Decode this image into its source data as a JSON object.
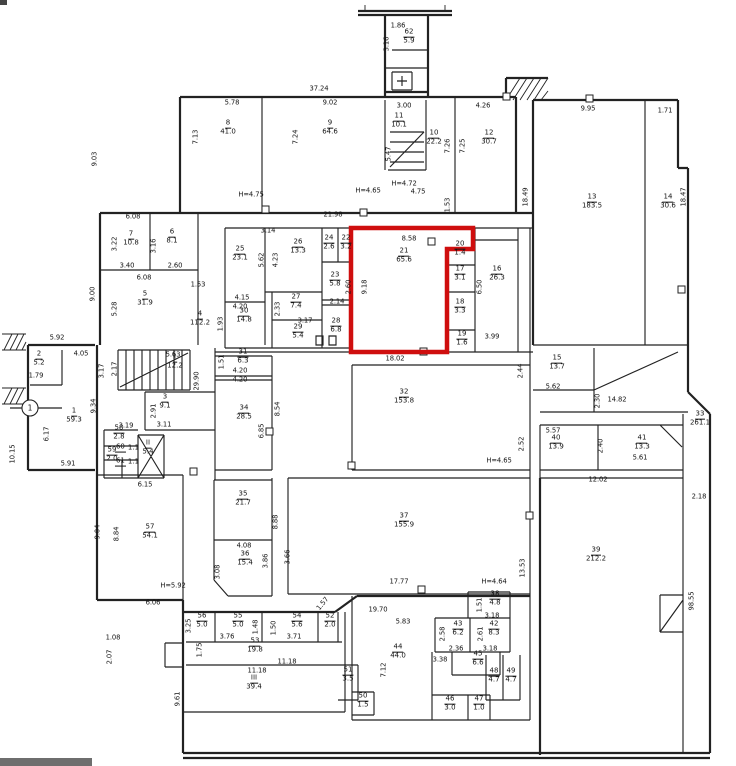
{
  "colors": {
    "wall": "#222222",
    "highlight": "#cf0e0e",
    "ink": "#141414",
    "paper": "#ffffff"
  },
  "highlight": {
    "room_no": "21",
    "area": "65.6",
    "width_dim": "8.58",
    "height_dim": "9.18",
    "bottom_dim": "18.02"
  },
  "rooms": [
    {
      "no": "62",
      "area": "5.9",
      "x": 409,
      "y": 37
    },
    {
      "no": "8",
      "area": "41.0",
      "x": 228,
      "y": 128
    },
    {
      "no": "9",
      "area": "64.6",
      "x": 330,
      "y": 128
    },
    {
      "no": "11",
      "area": "10.1",
      "x": 399,
      "y": 121
    },
    {
      "no": "10",
      "area": "22.2",
      "x": 434,
      "y": 138
    },
    {
      "no": "12",
      "area": "30.7",
      "x": 489,
      "y": 138
    },
    {
      "no": "13",
      "area": "183.5",
      "x": 592,
      "y": 202
    },
    {
      "no": "14",
      "area": "30.6",
      "x": 668,
      "y": 202
    },
    {
      "no": "7",
      "area": "10.8",
      "x": 131,
      "y": 239
    },
    {
      "no": "6",
      "area": "8.1",
      "x": 172,
      "y": 237
    },
    {
      "no": "5",
      "area": "31.9",
      "x": 145,
      "y": 299
    },
    {
      "no": "4",
      "area": "112.2",
      "x": 200,
      "y": 319
    },
    {
      "no": "25",
      "area": "23.1",
      "x": 240,
      "y": 254
    },
    {
      "no": "26",
      "area": "13.3",
      "x": 298,
      "y": 247
    },
    {
      "no": "24",
      "area": "2.6",
      "x": 329,
      "y": 243
    },
    {
      "no": "22",
      "area": "3.2",
      "x": 346,
      "y": 243
    },
    {
      "no": "23",
      "area": "5.8",
      "x": 335,
      "y": 280
    },
    {
      "no": "30",
      "area": "14.8",
      "x": 244,
      "y": 316
    },
    {
      "no": "27",
      "area": "7.4",
      "x": 296,
      "y": 302
    },
    {
      "no": "29",
      "area": "5.4",
      "x": 298,
      "y": 332
    },
    {
      "no": "28",
      "area": "6.8",
      "x": 336,
      "y": 326
    },
    {
      "no": "21",
      "area": "65.6",
      "x": 404,
      "y": 256
    },
    {
      "no": "20",
      "area": "1.4",
      "x": 460,
      "y": 249
    },
    {
      "no": "17",
      "area": "3.1",
      "x": 460,
      "y": 274
    },
    {
      "no": "18",
      "area": "3.3",
      "x": 460,
      "y": 307
    },
    {
      "no": "19",
      "area": "1.6",
      "x": 462,
      "y": 339
    },
    {
      "no": "16",
      "area": "26.3",
      "x": 497,
      "y": 274
    },
    {
      "no": "15",
      "area": "13.7",
      "x": 557,
      "y": 363
    },
    {
      "no": "33",
      "area": "261.1",
      "x": 700,
      "y": 419
    },
    {
      "no": "2",
      "area": "5.2",
      "x": 39,
      "y": 359
    },
    {
      "no": "1",
      "area": "59.3",
      "x": 74,
      "y": 416
    },
    {
      "no": "I",
      "area": "12.2",
      "x": 175,
      "y": 362
    },
    {
      "no": "3",
      "area": "9.1",
      "x": 165,
      "y": 402
    },
    {
      "no": "58",
      "area": "2.8",
      "x": 119,
      "y": 433
    },
    {
      "no": "59",
      "area": "2.0",
      "x": 112,
      "y": 455
    },
    {
      "no": "60",
      "area": "1.1",
      "x": 127,
      "y": 448,
      "h": true
    },
    {
      "no": "61",
      "area": "1.1",
      "x": 127,
      "y": 462,
      "h": true
    },
    {
      "no": "II",
      "area": "5.4",
      "x": 148,
      "y": 448
    },
    {
      "no": "57",
      "area": "54.1",
      "x": 150,
      "y": 532
    },
    {
      "no": "31",
      "area": "6.3",
      "x": 243,
      "y": 357
    },
    {
      "no": "34",
      "area": "28.5",
      "x": 244,
      "y": 413
    },
    {
      "no": "32",
      "area": "153.8",
      "x": 404,
      "y": 397
    },
    {
      "no": "40",
      "area": "13.9",
      "x": 556,
      "y": 443
    },
    {
      "no": "41",
      "area": "13.3",
      "x": 642,
      "y": 443
    },
    {
      "no": "39",
      "area": "212.2",
      "x": 596,
      "y": 555
    },
    {
      "no": "35",
      "area": "21.7",
      "x": 243,
      "y": 499
    },
    {
      "no": "36",
      "area": "15.4",
      "x": 245,
      "y": 559
    },
    {
      "no": "37",
      "area": "155.9",
      "x": 404,
      "y": 521
    },
    {
      "no": "56",
      "area": "5.0",
      "x": 202,
      "y": 621
    },
    {
      "no": "55",
      "area": "5.0",
      "x": 238,
      "y": 621
    },
    {
      "no": "54",
      "area": "5.6",
      "x": 297,
      "y": 621
    },
    {
      "no": "52",
      "area": "2.0",
      "x": 330,
      "y": 621
    },
    {
      "no": "53",
      "area": "19.8",
      "x": 255,
      "y": 646
    },
    {
      "no": "III",
      "area": "39.4",
      "x": 254,
      "y": 683
    },
    {
      "no": "51",
      "area": "3.5",
      "x": 348,
      "y": 675
    },
    {
      "no": "50",
      "area": "1.5",
      "x": 363,
      "y": 701
    },
    {
      "no": "38",
      "area": "4.8",
      "x": 495,
      "y": 599
    },
    {
      "no": "43",
      "area": "6.2",
      "x": 458,
      "y": 629
    },
    {
      "no": "42",
      "area": "8.3",
      "x": 494,
      "y": 629
    },
    {
      "no": "44",
      "area": "44.0",
      "x": 398,
      "y": 652
    },
    {
      "no": "45",
      "area": "6.6",
      "x": 478,
      "y": 659
    },
    {
      "no": "48",
      "area": "4.7",
      "x": 494,
      "y": 676
    },
    {
      "no": "49",
      "area": "4.7",
      "x": 511,
      "y": 676
    },
    {
      "no": "46",
      "area": "3.0",
      "x": 450,
      "y": 704
    },
    {
      "no": "47",
      "area": "1.0",
      "x": 479,
      "y": 704
    }
  ],
  "dims": [
    {
      "t": "1.86",
      "x": 398,
      "y": 26
    },
    {
      "t": "3.16",
      "x": 387,
      "y": 44,
      "r": 1
    },
    {
      "t": "37.24",
      "x": 319,
      "y": 89
    },
    {
      "t": "5.78",
      "x": 232,
      "y": 103
    },
    {
      "t": "9.02",
      "x": 330,
      "y": 103
    },
    {
      "t": "3.00",
      "x": 404,
      "y": 106
    },
    {
      "t": "4.26",
      "x": 483,
      "y": 106
    },
    {
      "t": "9.95",
      "x": 588,
      "y": 109
    },
    {
      "t": "1.71",
      "x": 665,
      "y": 111
    },
    {
      "t": "7.13",
      "x": 196,
      "y": 137,
      "r": 1
    },
    {
      "t": "7.24",
      "x": 296,
      "y": 137,
      "r": 1
    },
    {
      "t": "5.47",
      "x": 389,
      "y": 154,
      "r": 1
    },
    {
      "t": "7.26",
      "x": 448,
      "y": 146,
      "r": 1
    },
    {
      "t": "7.25",
      "x": 463,
      "y": 146,
      "r": 1
    },
    {
      "t": "18.49",
      "x": 526,
      "y": 197,
      "r": 1
    },
    {
      "t": "18.47",
      "x": 684,
      "y": 197,
      "r": 1
    },
    {
      "t": "H=4.75",
      "x": 251,
      "y": 195
    },
    {
      "t": "H=4.65",
      "x": 368,
      "y": 191
    },
    {
      "t": "H=4.72",
      "x": 404,
      "y": 184
    },
    {
      "t": "4.75",
      "x": 418,
      "y": 192
    },
    {
      "t": "1.53",
      "x": 448,
      "y": 205,
      "r": 1
    },
    {
      "t": "9.03",
      "x": 95,
      "y": 159,
      "r": 1
    },
    {
      "t": "6.08",
      "x": 133,
      "y": 217
    },
    {
      "t": "21.98",
      "x": 333,
      "y": 215
    },
    {
      "t": "3.22",
      "x": 115,
      "y": 244,
      "r": 1
    },
    {
      "t": "3.40",
      "x": 127,
      "y": 266
    },
    {
      "t": "3.16",
      "x": 154,
      "y": 246,
      "r": 1
    },
    {
      "t": "2.60",
      "x": 175,
      "y": 266
    },
    {
      "t": "6.08",
      "x": 144,
      "y": 278
    },
    {
      "t": "9.00",
      "x": 93,
      "y": 294,
      "r": 1
    },
    {
      "t": "5.28",
      "x": 115,
      "y": 309,
      "r": 1
    },
    {
      "t": "1.53",
      "x": 198,
      "y": 285
    },
    {
      "t": "2.14",
      "x": 337,
      "y": 302
    },
    {
      "t": "2.60",
      "x": 349,
      "y": 287,
      "r": 1
    },
    {
      "t": "3.14",
      "x": 268,
      "y": 231
    },
    {
      "t": "4.23",
      "x": 276,
      "y": 260,
      "r": 1
    },
    {
      "t": "5.62",
      "x": 262,
      "y": 260,
      "r": 1
    },
    {
      "t": "4.15",
      "x": 242,
      "y": 298
    },
    {
      "t": "4.20",
      "x": 240,
      "y": 307
    },
    {
      "t": "1.93",
      "x": 221,
      "y": 324,
      "r": 1
    },
    {
      "t": "2.33",
      "x": 278,
      "y": 309,
      "r": 1
    },
    {
      "t": "3.17",
      "x": 305,
      "y": 321
    },
    {
      "t": "8.58",
      "x": 409,
      "y": 239
    },
    {
      "t": "9.18",
      "x": 365,
      "y": 287,
      "r": 1
    },
    {
      "t": "18.02",
      "x": 395,
      "y": 359
    },
    {
      "t": "6.50",
      "x": 480,
      "y": 287,
      "r": 1
    },
    {
      "t": "3.99",
      "x": 492,
      "y": 337
    },
    {
      "t": "2.44",
      "x": 521,
      "y": 371,
      "r": 1
    },
    {
      "t": "5.62",
      "x": 553,
      "y": 387
    },
    {
      "t": "2.30",
      "x": 598,
      "y": 401,
      "r": 1
    },
    {
      "t": "14.82",
      "x": 617,
      "y": 400
    },
    {
      "t": "5.92",
      "x": 57,
      "y": 338
    },
    {
      "t": "1.79",
      "x": 36,
      "y": 376
    },
    {
      "t": "4.05",
      "x": 81,
      "y": 354
    },
    {
      "t": "3.17",
      "x": 102,
      "y": 371,
      "r": 1
    },
    {
      "t": "2.17",
      "x": 115,
      "y": 369,
      "r": 1
    },
    {
      "t": "9.34",
      "x": 94,
      "y": 406,
      "r": 1
    },
    {
      "t": "6.17",
      "x": 47,
      "y": 434,
      "r": 1
    },
    {
      "t": "10.15",
      "x": 13,
      "y": 454,
      "r": 1
    },
    {
      "t": "5.91",
      "x": 68,
      "y": 464
    },
    {
      "t": "5.63",
      "x": 173,
      "y": 355
    },
    {
      "t": "29.90",
      "x": 197,
      "y": 381,
      "r": 1
    },
    {
      "t": "2.91",
      "x": 154,
      "y": 411,
      "r": 1
    },
    {
      "t": "3.11",
      "x": 164,
      "y": 425
    },
    {
      "t": "3.19",
      "x": 126,
      "y": 426
    },
    {
      "t": "6.15",
      "x": 145,
      "y": 485
    },
    {
      "t": "9.04",
      "x": 98,
      "y": 532,
      "r": 1
    },
    {
      "t": "8.84",
      "x": 117,
      "y": 534,
      "r": 1
    },
    {
      "t": "H=5.92",
      "x": 173,
      "y": 586
    },
    {
      "t": "6.06",
      "x": 153,
      "y": 603
    },
    {
      "t": "1.51",
      "x": 222,
      "y": 362,
      "r": 1
    },
    {
      "t": "4.20",
      "x": 240,
      "y": 371
    },
    {
      "t": "4.20",
      "x": 240,
      "y": 380
    },
    {
      "t": "8.54",
      "x": 278,
      "y": 409,
      "r": 1
    },
    {
      "t": "6.85",
      "x": 262,
      "y": 431,
      "r": 1
    },
    {
      "t": "2.52",
      "x": 522,
      "y": 444,
      "r": 1
    },
    {
      "t": "H=4.65",
      "x": 499,
      "y": 461
    },
    {
      "t": "5.57",
      "x": 553,
      "y": 431
    },
    {
      "t": "2.40",
      "x": 601,
      "y": 446,
      "r": 1
    },
    {
      "t": "5.61",
      "x": 640,
      "y": 458
    },
    {
      "t": "12.02",
      "x": 598,
      "y": 480
    },
    {
      "t": "2.18",
      "x": 699,
      "y": 497
    },
    {
      "t": "98.55",
      "x": 692,
      "y": 601,
      "r": 1
    },
    {
      "t": "8.88",
      "x": 276,
      "y": 522,
      "r": 1
    },
    {
      "t": "4.08",
      "x": 244,
      "y": 546
    },
    {
      "t": "3.86",
      "x": 266,
      "y": 561,
      "r": 1
    },
    {
      "t": "3.08",
      "x": 218,
      "y": 572,
      "r": 1
    },
    {
      "t": "3.66",
      "x": 288,
      "y": 557,
      "r": 1
    },
    {
      "t": "17.77",
      "x": 399,
      "y": 582
    },
    {
      "t": "H=4.64",
      "x": 494,
      "y": 582
    },
    {
      "t": "13.53",
      "x": 523,
      "y": 568,
      "r": 1
    },
    {
      "t": "1.57",
      "x": 323,
      "y": 604,
      "r": 2
    },
    {
      "t": "19.70",
      "x": 378,
      "y": 610
    },
    {
      "t": "5.83",
      "x": 403,
      "y": 622
    },
    {
      "t": "3.25",
      "x": 189,
      "y": 626,
      "r": 1
    },
    {
      "t": "3.76",
      "x": 227,
      "y": 637
    },
    {
      "t": "1.48",
      "x": 256,
      "y": 627,
      "r": 1
    },
    {
      "t": "1.50",
      "x": 274,
      "y": 628,
      "r": 1
    },
    {
      "t": "3.71",
      "x": 294,
      "y": 637
    },
    {
      "t": "1.75",
      "x": 200,
      "y": 650,
      "r": 1
    },
    {
      "t": "11.18",
      "x": 287,
      "y": 662
    },
    {
      "t": "11.18",
      "x": 257,
      "y": 671
    },
    {
      "t": "1.08",
      "x": 113,
      "y": 638
    },
    {
      "t": "2.07",
      "x": 110,
      "y": 657,
      "r": 1
    },
    {
      "t": "9.61",
      "x": 178,
      "y": 699,
      "r": 1
    },
    {
      "t": "1.51",
      "x": 480,
      "y": 605,
      "r": 1
    },
    {
      "t": "3.18",
      "x": 492,
      "y": 616
    },
    {
      "t": "2.58",
      "x": 443,
      "y": 634,
      "r": 1
    },
    {
      "t": "2.36",
      "x": 456,
      "y": 649
    },
    {
      "t": "2.61",
      "x": 481,
      "y": 634,
      "r": 1
    },
    {
      "t": "3.18",
      "x": 490,
      "y": 649
    },
    {
      "t": "7.12",
      "x": 384,
      "y": 670,
      "r": 1
    },
    {
      "t": "3.38",
      "x": 440,
      "y": 660
    }
  ],
  "axis_markers": [
    {
      "label": "1",
      "x": 30,
      "y": 408
    }
  ]
}
